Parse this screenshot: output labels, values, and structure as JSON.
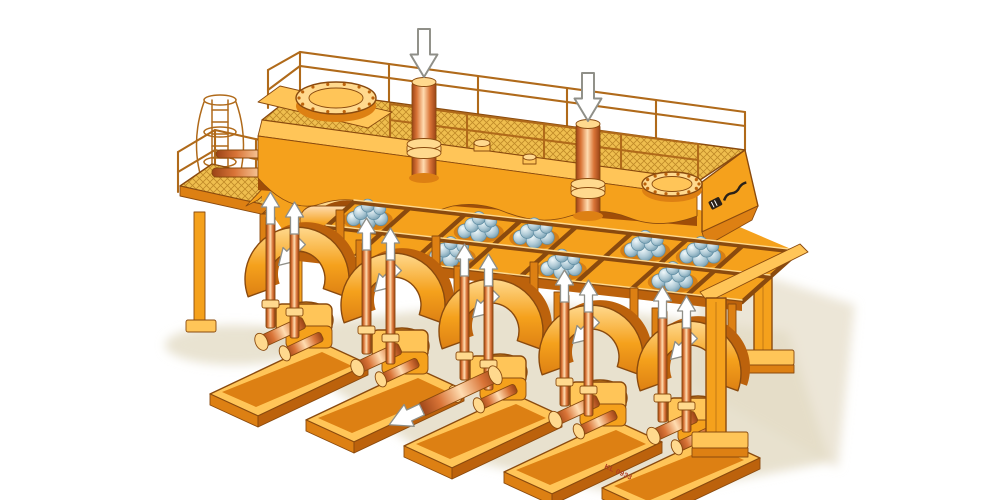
{
  "illustration": {
    "subject": "Isometric cutaway illustration of a five-stand industrial machine with overhead walkway",
    "plate_code": "KL 0933",
    "logo": "manufacturer wordmark (illegible italic script on end face)",
    "drive_units": {
      "count": 5
    },
    "billet_bundles": {
      "cells": [
        [
          0,
          1
        ],
        [
          2,
          0
        ],
        [
          2,
          1
        ],
        [
          3,
          1
        ],
        [
          4,
          0
        ],
        [
          5,
          1
        ],
        [
          6,
          0
        ],
        [
          6,
          1
        ]
      ]
    },
    "manholes": {
      "count": 2,
      "bolt_count": 14
    },
    "arrows": {
      "down_arrows_on_top_cylinders": 2,
      "up_arrows_on_push_rods": 10,
      "arrows_on_rocker_housings": 5,
      "output_shaft_arrow": 1
    }
  },
  "palette": {
    "paper": "#ffffff",
    "floor_shadow": "#e4dcc6",
    "body_orange": "#f5a11c",
    "body_orange_light": "#ffc558",
    "body_orange_pale": "#ffd98e",
    "body_orange_dark": "#dd8013",
    "body_orange_deep": "#bc620c",
    "interior_dark": "#a04e08",
    "outline_brown": "#8a4a0e",
    "railing": "#b06a1a",
    "grating_fill": "#efbe4e",
    "grating_line": "#c08a28",
    "copper_light": "#ffdcb0",
    "copper_mid": "#d97437",
    "copper_dark": "#9a4316",
    "ball_light": "#f0f8fa",
    "ball_mid": "#afcad6",
    "ball_dark": "#5e8ca2",
    "arrow_fill": "#ffffff",
    "arrow_stroke": "#8f8f88",
    "plate_red": "#b03a20",
    "logo_ink": "#2a2118"
  }
}
